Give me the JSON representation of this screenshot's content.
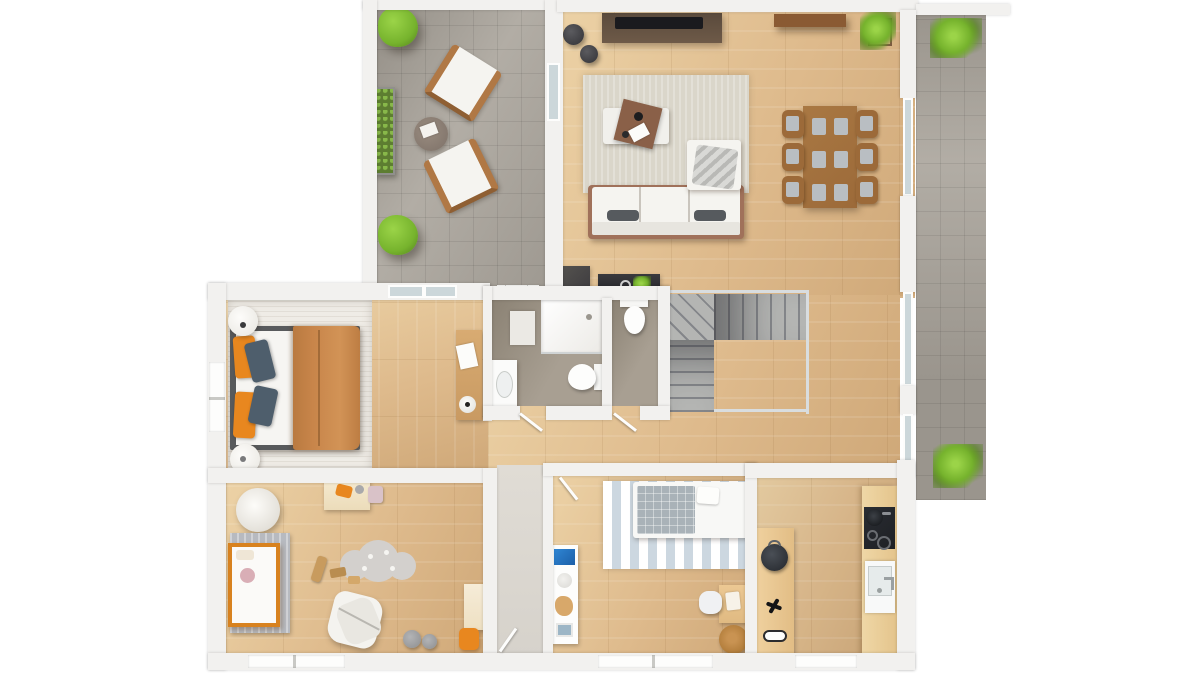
{
  "scene": {
    "kind": "3d-rendered-floor-plan",
    "view": "top-down orthographic",
    "text_labels": [],
    "rooms": [
      {
        "id": "terrace-upper",
        "contents": [
          "lounge-armchair",
          "lounge-armchair",
          "side-table",
          "planter-box",
          "bush",
          "bush"
        ]
      },
      {
        "id": "living-dining-room",
        "contents": [
          "tv-sideboard",
          "tv",
          "pouf",
          "pouf",
          "area-rug",
          "corner-sofa",
          "coffee-table",
          "dining-table",
          "dining-chairs-x6",
          "wall-shelf",
          "potted-plant",
          "console-table",
          "console-plant",
          "dark-cabinet",
          "white-cabinet"
        ]
      },
      {
        "id": "terrace-side",
        "contents": [
          "plant",
          "plant"
        ]
      },
      {
        "id": "master-bedroom",
        "contents": [
          "double-bed",
          "pillows",
          "nightstand",
          "nightstand",
          "bedroom-rug",
          "desk",
          "desk-lamp",
          "papers"
        ]
      },
      {
        "id": "bathroom",
        "contents": [
          "shower",
          "bath-mat",
          "vanity-sink",
          "toilet"
        ]
      },
      {
        "id": "wc",
        "contents": [
          "toilet"
        ]
      },
      {
        "id": "staircase",
        "contents": [
          "u-shaped-stairs",
          "glass-railing"
        ]
      },
      {
        "id": "kids-room",
        "contents": [
          "crib",
          "knit-blanket",
          "floor-basket",
          "play-table",
          "cloud-rug",
          "wooden-toys",
          "play-tent",
          "pouf",
          "pouf",
          "kids-desk",
          "orange-chair"
        ]
      },
      {
        "id": "entry-hall",
        "contents": [
          "front-door"
        ]
      },
      {
        "id": "bedroom-2",
        "contents": [
          "single-bed",
          "plaid-blanket",
          "striped-rug",
          "wall-shelf-unit",
          "desk",
          "chair",
          "jute-rug"
        ]
      },
      {
        "id": "kitchen-nook",
        "contents": [
          "tall-dresser",
          "bag",
          "star-decor",
          "tray",
          "kitchen-counter",
          "cooktop",
          "pot",
          "sink"
        ]
      }
    ]
  },
  "palette": {
    "bg": "#ffffff",
    "wall": "#f2f1ef",
    "wallShade": "#dddcd8",
    "wood": "#deba8c",
    "woodLight": "#ecd2a6",
    "woodDark": "#cfa878",
    "tile": "#b2ada5",
    "taupe": "#a89f92",
    "taupeDark": "#8b8274",
    "glass": "#ccd7da",
    "rail": "#d9dddf",
    "rugLiving": "#dad6ca",
    "rugBedroom": "#efece6",
    "sofa": "#f5f4f0",
    "brown": "#9c6a39",
    "brownDark": "#6e5a48",
    "tv": "#1a1a1e",
    "caramel": "#c8854a",
    "orange": "#e8871f",
    "slate": "#4e5e6c",
    "green": "#76b32d",
    "greenLight": "#9bd448",
    "greenDark": "#527f1c",
    "grayBlanket": "#b7bac0",
    "plaid": "#a9b2b8",
    "cloudRug": "#d3d0cd",
    "cribOrange": "#d8821f",
    "counter": "#efd7a6",
    "cooktop": "#1e2024",
    "jute": "#b5803e",
    "entryFloor": "#d6d2cb",
    "stairLight": "#b4b5b3",
    "stairDark": "#84868a",
    "cushion": "#b9bec2",
    "stripe": "#ccd7e0"
  }
}
